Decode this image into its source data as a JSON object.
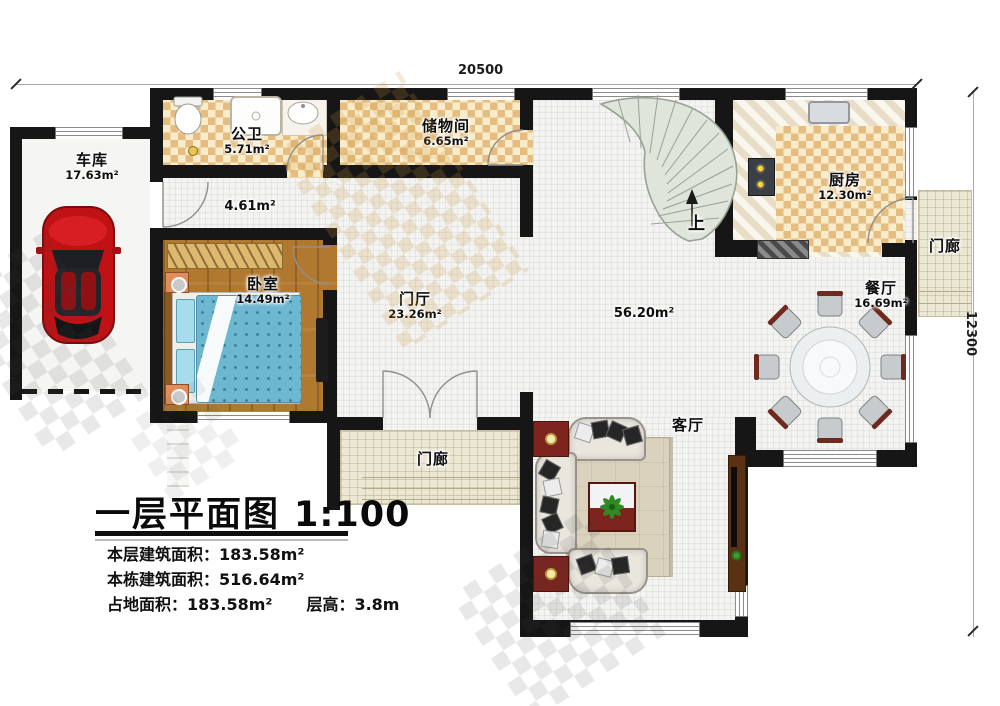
{
  "title": {
    "text": "一层平面图",
    "scale": "1:100"
  },
  "stats": [
    {
      "label": "本层建筑面积：",
      "value": "183.58m²"
    },
    {
      "label": "本栋建筑面积：",
      "value": "516.64m²"
    },
    {
      "label": "占地面积：",
      "value": "183.58m²"
    },
    {
      "label": "层高：",
      "value": "3.8m"
    }
  ],
  "dimensions": {
    "width": "20500",
    "height": "12300"
  },
  "rooms": {
    "garage": {
      "name": "车库",
      "area": "17.63m²"
    },
    "bathroom": {
      "name": "公卫",
      "area": "5.71m²"
    },
    "storage": {
      "name": "储物间",
      "area": "6.65m²"
    },
    "hall": {
      "area": "4.61m²"
    },
    "bedroom": {
      "name": "卧室",
      "area": "14.49m²"
    },
    "foyer": {
      "name": "门厅",
      "area": "23.26m²"
    },
    "great_room": {
      "area": "56.20m²"
    },
    "kitchen": {
      "name": "厨房",
      "area": "12.30m²"
    },
    "dining": {
      "name": "餐厅",
      "area": "16.69m²"
    },
    "living": {
      "name": "客厅"
    },
    "porch_right": {
      "name": "门廊"
    },
    "porch_front": {
      "name": "门廊"
    }
  },
  "stairs": {
    "direction_label": "上"
  },
  "colors": {
    "wall": "#161616",
    "tile_dark": "#e6bd80",
    "tile_light": "#f8ecca",
    "wood_floor": "#b0792f",
    "stair_fill": "#dfe5da",
    "accent_red": "#7c241d",
    "car_red": "#c01215",
    "bed_blue": "#6db8d0"
  }
}
